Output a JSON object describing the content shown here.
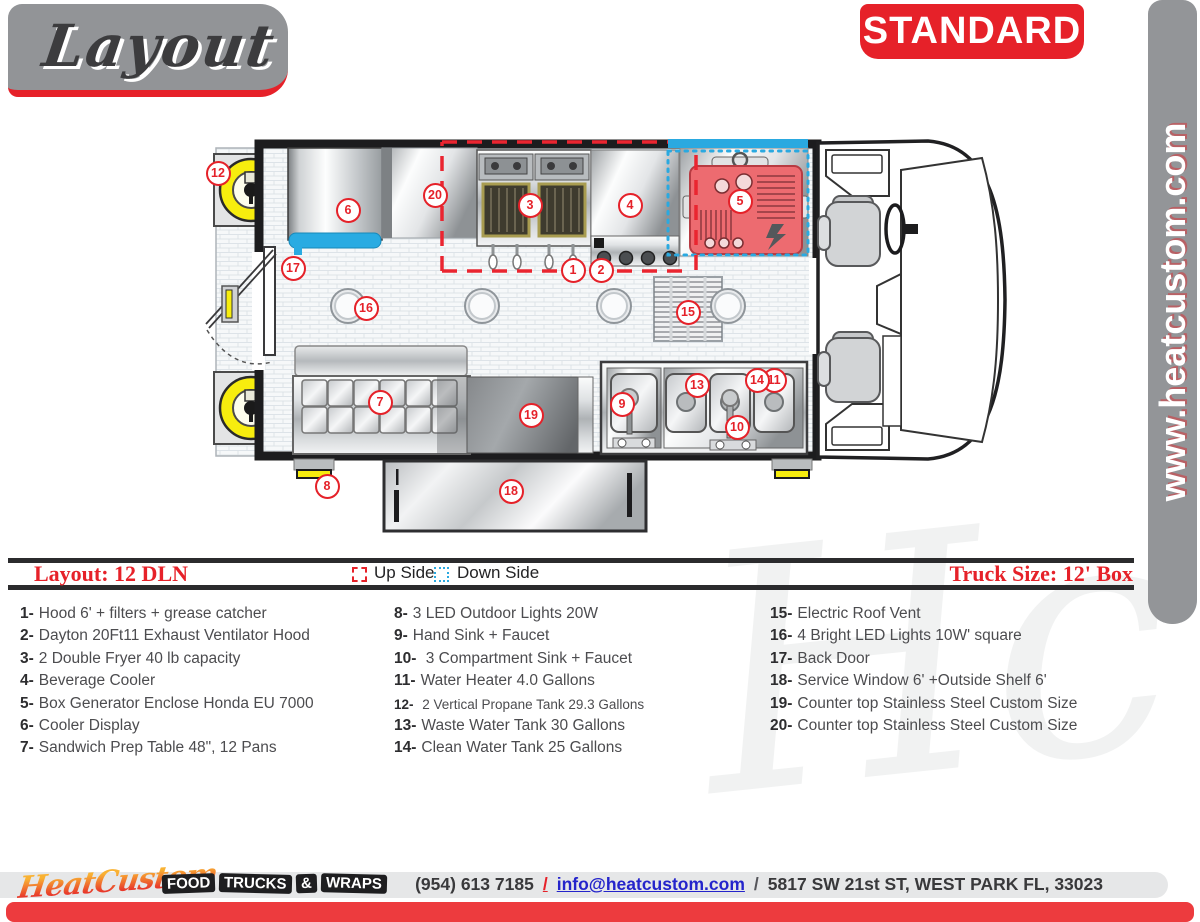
{
  "header": {
    "logo_text": "Layout",
    "badge": "STANDARD"
  },
  "side_rail": {
    "url": "www.heatcustom.com"
  },
  "legend": {
    "layout_label": "Layout: 12 DLN",
    "up_side": "Up Side",
    "down_side": "Down Side",
    "truck_size": "Truck Size: 12' Box"
  },
  "plan": {
    "colors": {
      "accent_red": "#E62129",
      "accent_blue": "#29ABE2",
      "tank_yellow": "#F7ED0E"
    },
    "markers": [
      {
        "n": "1",
        "x": 573,
        "y": 270
      },
      {
        "n": "2",
        "x": 601,
        "y": 270
      },
      {
        "n": "3",
        "x": 530,
        "y": 205
      },
      {
        "n": "4",
        "x": 630,
        "y": 205
      },
      {
        "n": "5",
        "x": 740,
        "y": 201
      },
      {
        "n": "6",
        "x": 348,
        "y": 210
      },
      {
        "n": "7",
        "x": 380,
        "y": 402
      },
      {
        "n": "8",
        "x": 327,
        "y": 486
      },
      {
        "n": "9",
        "x": 622,
        "y": 404
      },
      {
        "n": "10",
        "x": 737,
        "y": 427
      },
      {
        "n": "11",
        "x": 774,
        "y": 380
      },
      {
        "n": "12",
        "x": 218,
        "y": 173
      },
      {
        "n": "13",
        "x": 697,
        "y": 385
      },
      {
        "n": "14",
        "x": 757,
        "y": 380
      },
      {
        "n": "15",
        "x": 688,
        "y": 312
      },
      {
        "n": "16",
        "x": 366,
        "y": 308
      },
      {
        "n": "17",
        "x": 293,
        "y": 268
      },
      {
        "n": "18",
        "x": 511,
        "y": 491
      },
      {
        "n": "19",
        "x": 531,
        "y": 415
      },
      {
        "n": "20",
        "x": 435,
        "y": 195
      }
    ]
  },
  "equipment_list": {
    "columns": [
      [
        {
          "n": "1",
          "text": "Hood 6' + filters + grease catcher"
        },
        {
          "n": "2",
          "text": "Dayton 20Ft11 Exhaust Ventilator Hood"
        },
        {
          "n": "3",
          "text": "2 Double Fryer 40 lb capacity"
        },
        {
          "n": "4",
          "text": "Beverage Cooler"
        },
        {
          "n": "5",
          "text": "Box Generator Enclose Honda EU 7000"
        },
        {
          "n": "6",
          "text": "Cooler Display"
        },
        {
          "n": "7",
          "text": "Sandwich Prep Table 48\", 12 Pans"
        }
      ],
      [
        {
          "n": "8",
          "text": "3 LED Outdoor Lights 20W"
        },
        {
          "n": "9",
          "text": "Hand Sink + Faucet"
        },
        {
          "n": "10",
          "text": " 3 Compartment Sink + Faucet"
        },
        {
          "n": "11",
          "text": "Water Heater 4.0 Gallons"
        },
        {
          "n": "12",
          "text": " 2 Vertical Propane Tank 29.3 Gallons",
          "small": true
        },
        {
          "n": "13",
          "text": "Waste Water Tank 30 Gallons"
        },
        {
          "n": "14",
          "text": "Clean Water Tank 25 Gallons"
        }
      ],
      [
        {
          "n": "15",
          "text": "Electric Roof Vent"
        },
        {
          "n": "16",
          "text": "4 Bright LED Lights 10W' square"
        },
        {
          "n": "17",
          "text": "Back Door"
        },
        {
          "n": "18",
          "text": "Service Window 6' +Outside Shelf 6'"
        },
        {
          "n": "19",
          "text": "Counter top Stainless Steel Custom Size"
        },
        {
          "n": "20",
          "text": "Counter top Stainless Steel Custom Size"
        }
      ]
    ]
  },
  "watermark": "Hc",
  "footer": {
    "brand": "HeatCustom",
    "tagline_words": [
      "FOOD",
      "TRUCKS",
      "&",
      "WRAPS"
    ],
    "phone": "(954) 613 7185",
    "separator1": "/",
    "email": "info@heatcustom.com",
    "separator2": "/",
    "address": "5817 SW 21st ST, WEST PARK FL, 33023"
  }
}
